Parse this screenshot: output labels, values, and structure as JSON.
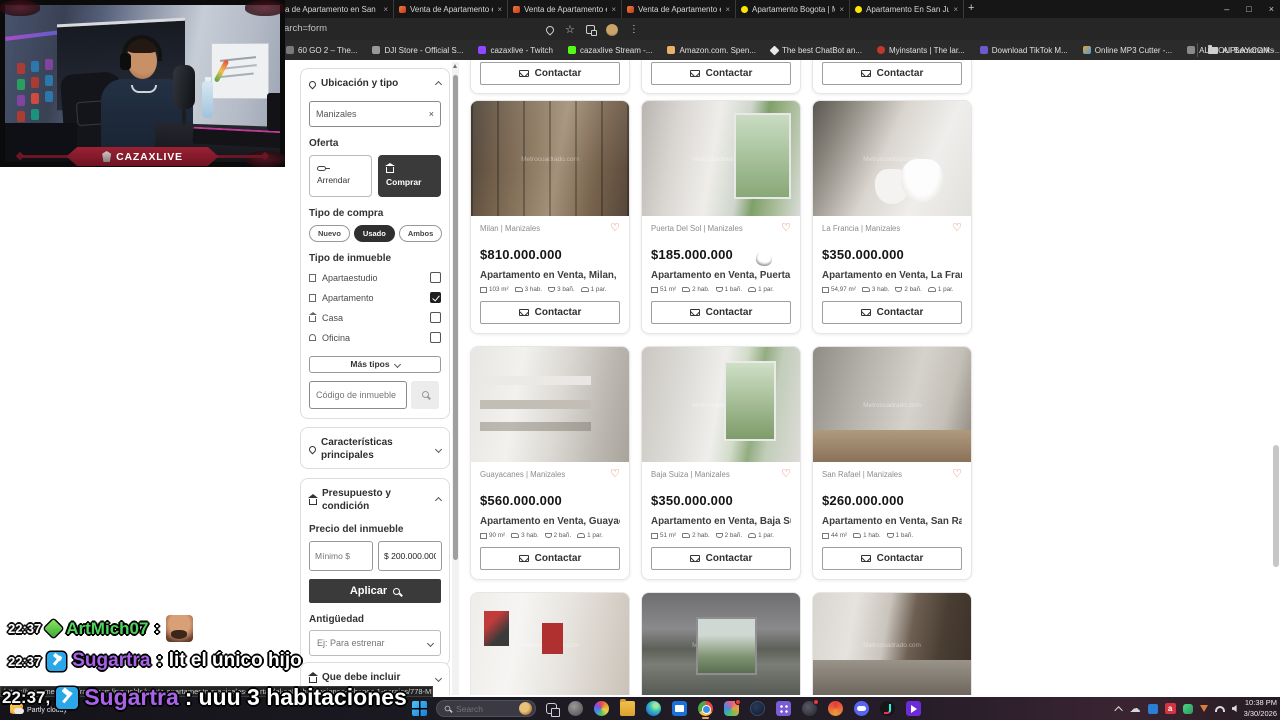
{
  "icons": {
    "close": "×",
    "new_tab": "+",
    "star": "☆",
    "menu": "⋮",
    "heart": "♡",
    "minimize": "–",
    "maximize": "□",
    "cloud": "☁",
    "red_a": "a"
  },
  "colors": {
    "accent_heart": "#e0604a",
    "dark_button": "#3a3a3a",
    "twitch_purple": "#9147ff",
    "kick_green": "#53fc18",
    "chat_name_green": "#4fd35a",
    "chat_name_purple": "#a963e8",
    "mod_badge_blue": "#2aa7e8"
  },
  "browser": {
    "tabs": [
      {
        "label": "a de Apartamento en San"
      },
      {
        "label": "Venta de Apartamento en Oro"
      },
      {
        "label": "Venta de Apartamento en Ama"
      },
      {
        "label": "Venta de Apartamento en Av c"
      },
      {
        "label": "Apartamento Bogota | Mercad"
      },
      {
        "label": "Apartamento En San Juan Bosc"
      }
    ],
    "address_fragment": "arch=form",
    "bookmarks": [
      {
        "label": "60 GO 2 – The..."
      },
      {
        "label": "DJI Store - Official S..."
      },
      {
        "label": "cazaxlive - Twitch"
      },
      {
        "label": "cazaxlive Stream -..."
      },
      {
        "label": "Amazon.com. Spen..."
      },
      {
        "label": "The best ChatBot an..."
      },
      {
        "label": "Myinstants | The lar..."
      },
      {
        "label": "Download TikTok M..."
      },
      {
        "label": "Online MP3 Cutter -..."
      },
      {
        "label": "ALLYOUPLAY.COM -..."
      },
      {
        "label": "El mejor software p..."
      },
      {
        "label": "Kick VOD Download..."
      }
    ],
    "all_bookmarks": "All Bookmarks"
  },
  "webcam": {
    "banner": "CAZAXLIVE"
  },
  "filters": {
    "ubicacion_title": "Ubicación y tipo",
    "search_value": "Manizales",
    "oferta_label": "Oferta",
    "arrendar_label": "Arrendar",
    "comprar_label": "Comprar",
    "oferta_selected": "Comprar",
    "tipo_compra_label": "Tipo de compra",
    "pill_nuevo": "Nuevo",
    "pill_usado": "Usado",
    "pill_ambos": "Ambos",
    "tipo_compra_selected": "Usado",
    "tipo_inmueble_label": "Tipo de inmueble",
    "types": [
      {
        "label": "Apartaestudio",
        "checked": false
      },
      {
        "label": "Apartamento",
        "checked": true
      },
      {
        "label": "Casa",
        "checked": false
      },
      {
        "label": "Oficina",
        "checked": false
      }
    ],
    "mas_tipos_label": "Más tipos",
    "codigo_placeholder": "Código de inmueble",
    "caracteristicas_title": "Características principales",
    "presupuesto_title": "Presupuesto y condición",
    "precio_label": "Precio del inmueble",
    "minimo_placeholder": "Mínimo $",
    "maximo_value": "$ 200.000.000",
    "aplicar_label": "Aplicar",
    "antiguedad_label": "Antigüedad",
    "antiguedad_placeholder": "Ej: Para estrenar",
    "incluir_title": "Que debe incluir"
  },
  "listings": {
    "contact_label": "Contactar",
    "watermark": "Metrocuadrado.com",
    "cards": [
      {
        "location": "Milan | Manizales",
        "price": "$810.000.000",
        "title": "Apartamento en Venta, Milan, Ma...",
        "specs": {
          "area": "103 m²",
          "rooms": "3 hab.",
          "baths": "3 bañ.",
          "parking": "1 par."
        }
      },
      {
        "location": "Puerta Del Sol | Manizales",
        "price": "$185.000.000",
        "title": "Apartamento en Venta, Puerta Del...",
        "specs": {
          "area": "51 m²",
          "rooms": "2 hab.",
          "baths": "1 bañ.",
          "parking": "1 par."
        }
      },
      {
        "location": "La Francia | Manizales",
        "price": "$350.000.000",
        "title": "Apartamento en Venta, La Francia...",
        "specs": {
          "area": "54,97 m²",
          "rooms": "3 hab.",
          "baths": "2 bañ.",
          "parking": "1 par."
        }
      },
      {
        "location": "Guayacanes | Manizales",
        "price": "$560.000.000",
        "title": "Apartamento en Venta, Guayacan...",
        "specs": {
          "area": "90 m²",
          "rooms": "3 hab.",
          "baths": "2 bañ.",
          "parking": "1 par."
        }
      },
      {
        "location": "Baja Suiza | Manizales",
        "price": "$350.000.000",
        "title": "Apartamento en Venta, Baja Suiza...",
        "specs": {
          "area": "51 m²",
          "rooms": "2 hab.",
          "baths": "2 bañ.",
          "parking": "1 par."
        }
      },
      {
        "location": "San Rafael | Manizales",
        "price": "$260.000.000",
        "title": "Apartamento en Venta, San Rafae...",
        "specs": {
          "area": "44 m²",
          "rooms": "1 hab.",
          "baths": "1 bañ.",
          "parking": ""
        }
      }
    ]
  },
  "chat": {
    "messages": [
      {
        "time": "22:37",
        "user": "ArtMich07",
        "separator": ":",
        "text": ""
      },
      {
        "time": "22:37",
        "user": "Sugartra",
        "separator": ":",
        "text": "lit el único hijo"
      },
      {
        "time": "22:37,",
        "user": "Sugartra",
        "separator": ":",
        "text": "uuu 3 habitaciones"
      }
    ]
  },
  "statusbar": {
    "url": "https://www.metrocuadrado.com/inmueble/venta-apartamento-manizales-puerta-del-sol-2-habitaciones-1-banos-1-garajes/778-M5591364?src_url=%2fapa..."
  },
  "taskbar": {
    "search_placeholder": "Search",
    "weather": "Partly cloudy",
    "clock_time": "10:38 PM",
    "clock_date": "3/30/2026"
  }
}
